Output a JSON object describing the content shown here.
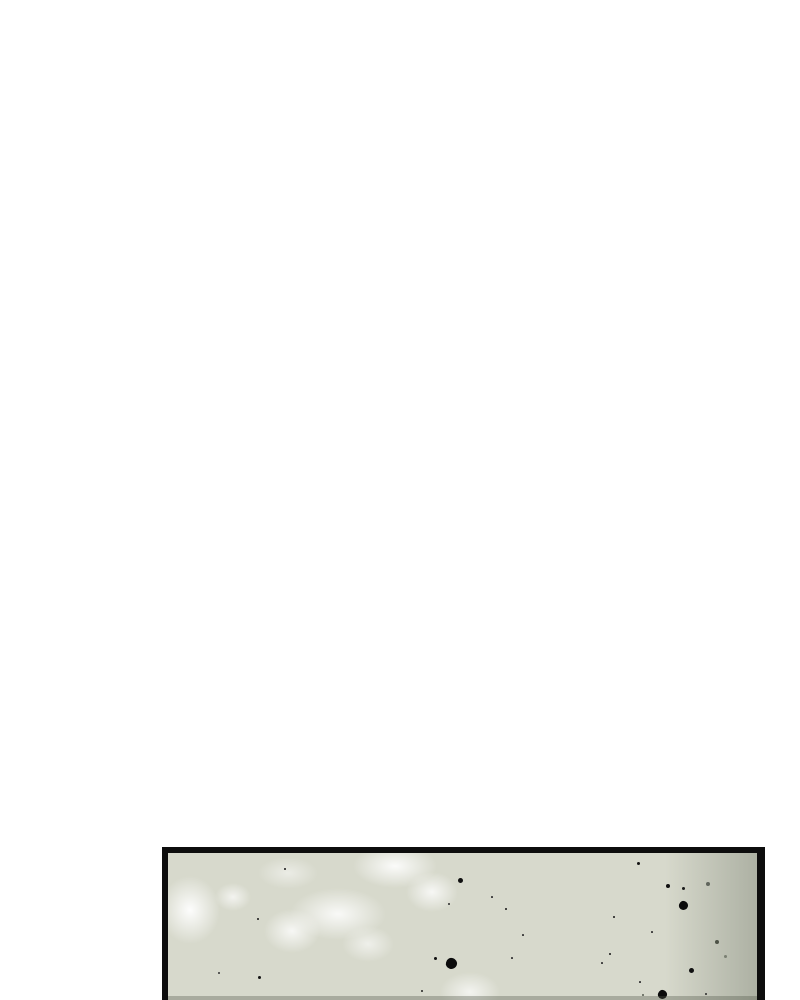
{
  "page": {
    "background_color": "#ffffff"
  },
  "panel": {
    "border_color": "#0d0d0d",
    "fill_color": "#d7d9cc",
    "artwork": {
      "highlights": [
        {
          "x": 22,
          "y": 57,
          "rx": 30,
          "ry": 34,
          "o": 0.95
        },
        {
          "x": 65,
          "y": 44,
          "rx": 18,
          "ry": 14,
          "o": 0.7
        },
        {
          "x": 120,
          "y": 20,
          "rx": 30,
          "ry": 16,
          "o": 0.5
        },
        {
          "x": 124,
          "y": 78,
          "rx": 28,
          "ry": 22,
          "o": 0.8
        },
        {
          "x": 170,
          "y": 61,
          "rx": 48,
          "ry": 26,
          "o": 0.85
        },
        {
          "x": 200,
          "y": 91,
          "rx": 26,
          "ry": 18,
          "o": 0.6
        },
        {
          "x": 227,
          "y": 13,
          "rx": 42,
          "ry": 22,
          "o": 0.9
        },
        {
          "x": 264,
          "y": 39,
          "rx": 26,
          "ry": 20,
          "o": 0.8
        },
        {
          "x": 302,
          "y": 139,
          "rx": 30,
          "ry": 20,
          "o": 0.7
        }
      ],
      "highlight_color": "255,255,255",
      "speckles": [
        {
          "x": 117,
          "y": 16,
          "d": 2,
          "c": "#151515"
        },
        {
          "x": 292,
          "y": 27,
          "d": 5,
          "c": "#101010"
        },
        {
          "x": 281,
          "y": 51,
          "d": 2,
          "c": "#2a2a2a"
        },
        {
          "x": 90,
          "y": 66,
          "d": 2,
          "c": "#151515"
        },
        {
          "x": 267,
          "y": 105,
          "d": 3,
          "c": "#101010"
        },
        {
          "x": 283,
          "y": 110,
          "d": 11,
          "c": "#0b0b0b",
          "shape": "blob"
        },
        {
          "x": 51,
          "y": 120,
          "d": 2,
          "c": "#333333"
        },
        {
          "x": 91,
          "y": 124,
          "d": 3,
          "c": "#141414"
        },
        {
          "x": 254,
          "y": 138,
          "d": 2,
          "c": "#222222"
        },
        {
          "x": 470,
          "y": 10,
          "d": 3,
          "c": "#141414"
        },
        {
          "x": 500,
          "y": 33,
          "d": 4,
          "c": "#101010"
        },
        {
          "x": 515,
          "y": 35,
          "d": 3,
          "c": "#1a1a1a"
        },
        {
          "x": 540,
          "y": 31,
          "d": 4,
          "c": "#60655c"
        },
        {
          "x": 515,
          "y": 52,
          "d": 9,
          "c": "#0b0b0b",
          "shape": "blob"
        },
        {
          "x": 338,
          "y": 56,
          "d": 2,
          "c": "#151515"
        },
        {
          "x": 446,
          "y": 64,
          "d": 2,
          "c": "#151515"
        },
        {
          "x": 324,
          "y": 44,
          "d": 1.5,
          "c": "#333333"
        },
        {
          "x": 355,
          "y": 82,
          "d": 1.5,
          "c": "#333333"
        },
        {
          "x": 484,
          "y": 79,
          "d": 1.5,
          "c": "#333333"
        },
        {
          "x": 344,
          "y": 105,
          "d": 1.5,
          "c": "#333333"
        },
        {
          "x": 442,
          "y": 101,
          "d": 2,
          "c": "#151515"
        },
        {
          "x": 434,
          "y": 110,
          "d": 1.5,
          "c": "#333333"
        },
        {
          "x": 549,
          "y": 89,
          "d": 4,
          "c": "#4d5246"
        },
        {
          "x": 557,
          "y": 103,
          "d": 3,
          "c": "#7a7f72"
        },
        {
          "x": 523,
          "y": 117,
          "d": 5,
          "c": "#101010"
        },
        {
          "x": 472,
          "y": 129,
          "d": 1.5,
          "c": "#333333"
        },
        {
          "x": 475,
          "y": 142,
          "d": 2,
          "c": "#565b50"
        },
        {
          "x": 494,
          "y": 141,
          "d": 9,
          "c": "#0b0b0b",
          "shape": "blob"
        },
        {
          "x": 538,
          "y": 141,
          "d": 2,
          "c": "#2a2a2a"
        }
      ],
      "right_shade": {
        "width": 92,
        "color": "rgba(122,128,114,0.45)"
      },
      "bottom_shade": {
        "height": 4,
        "color": "rgba(80,86,72,0.35)"
      }
    }
  }
}
